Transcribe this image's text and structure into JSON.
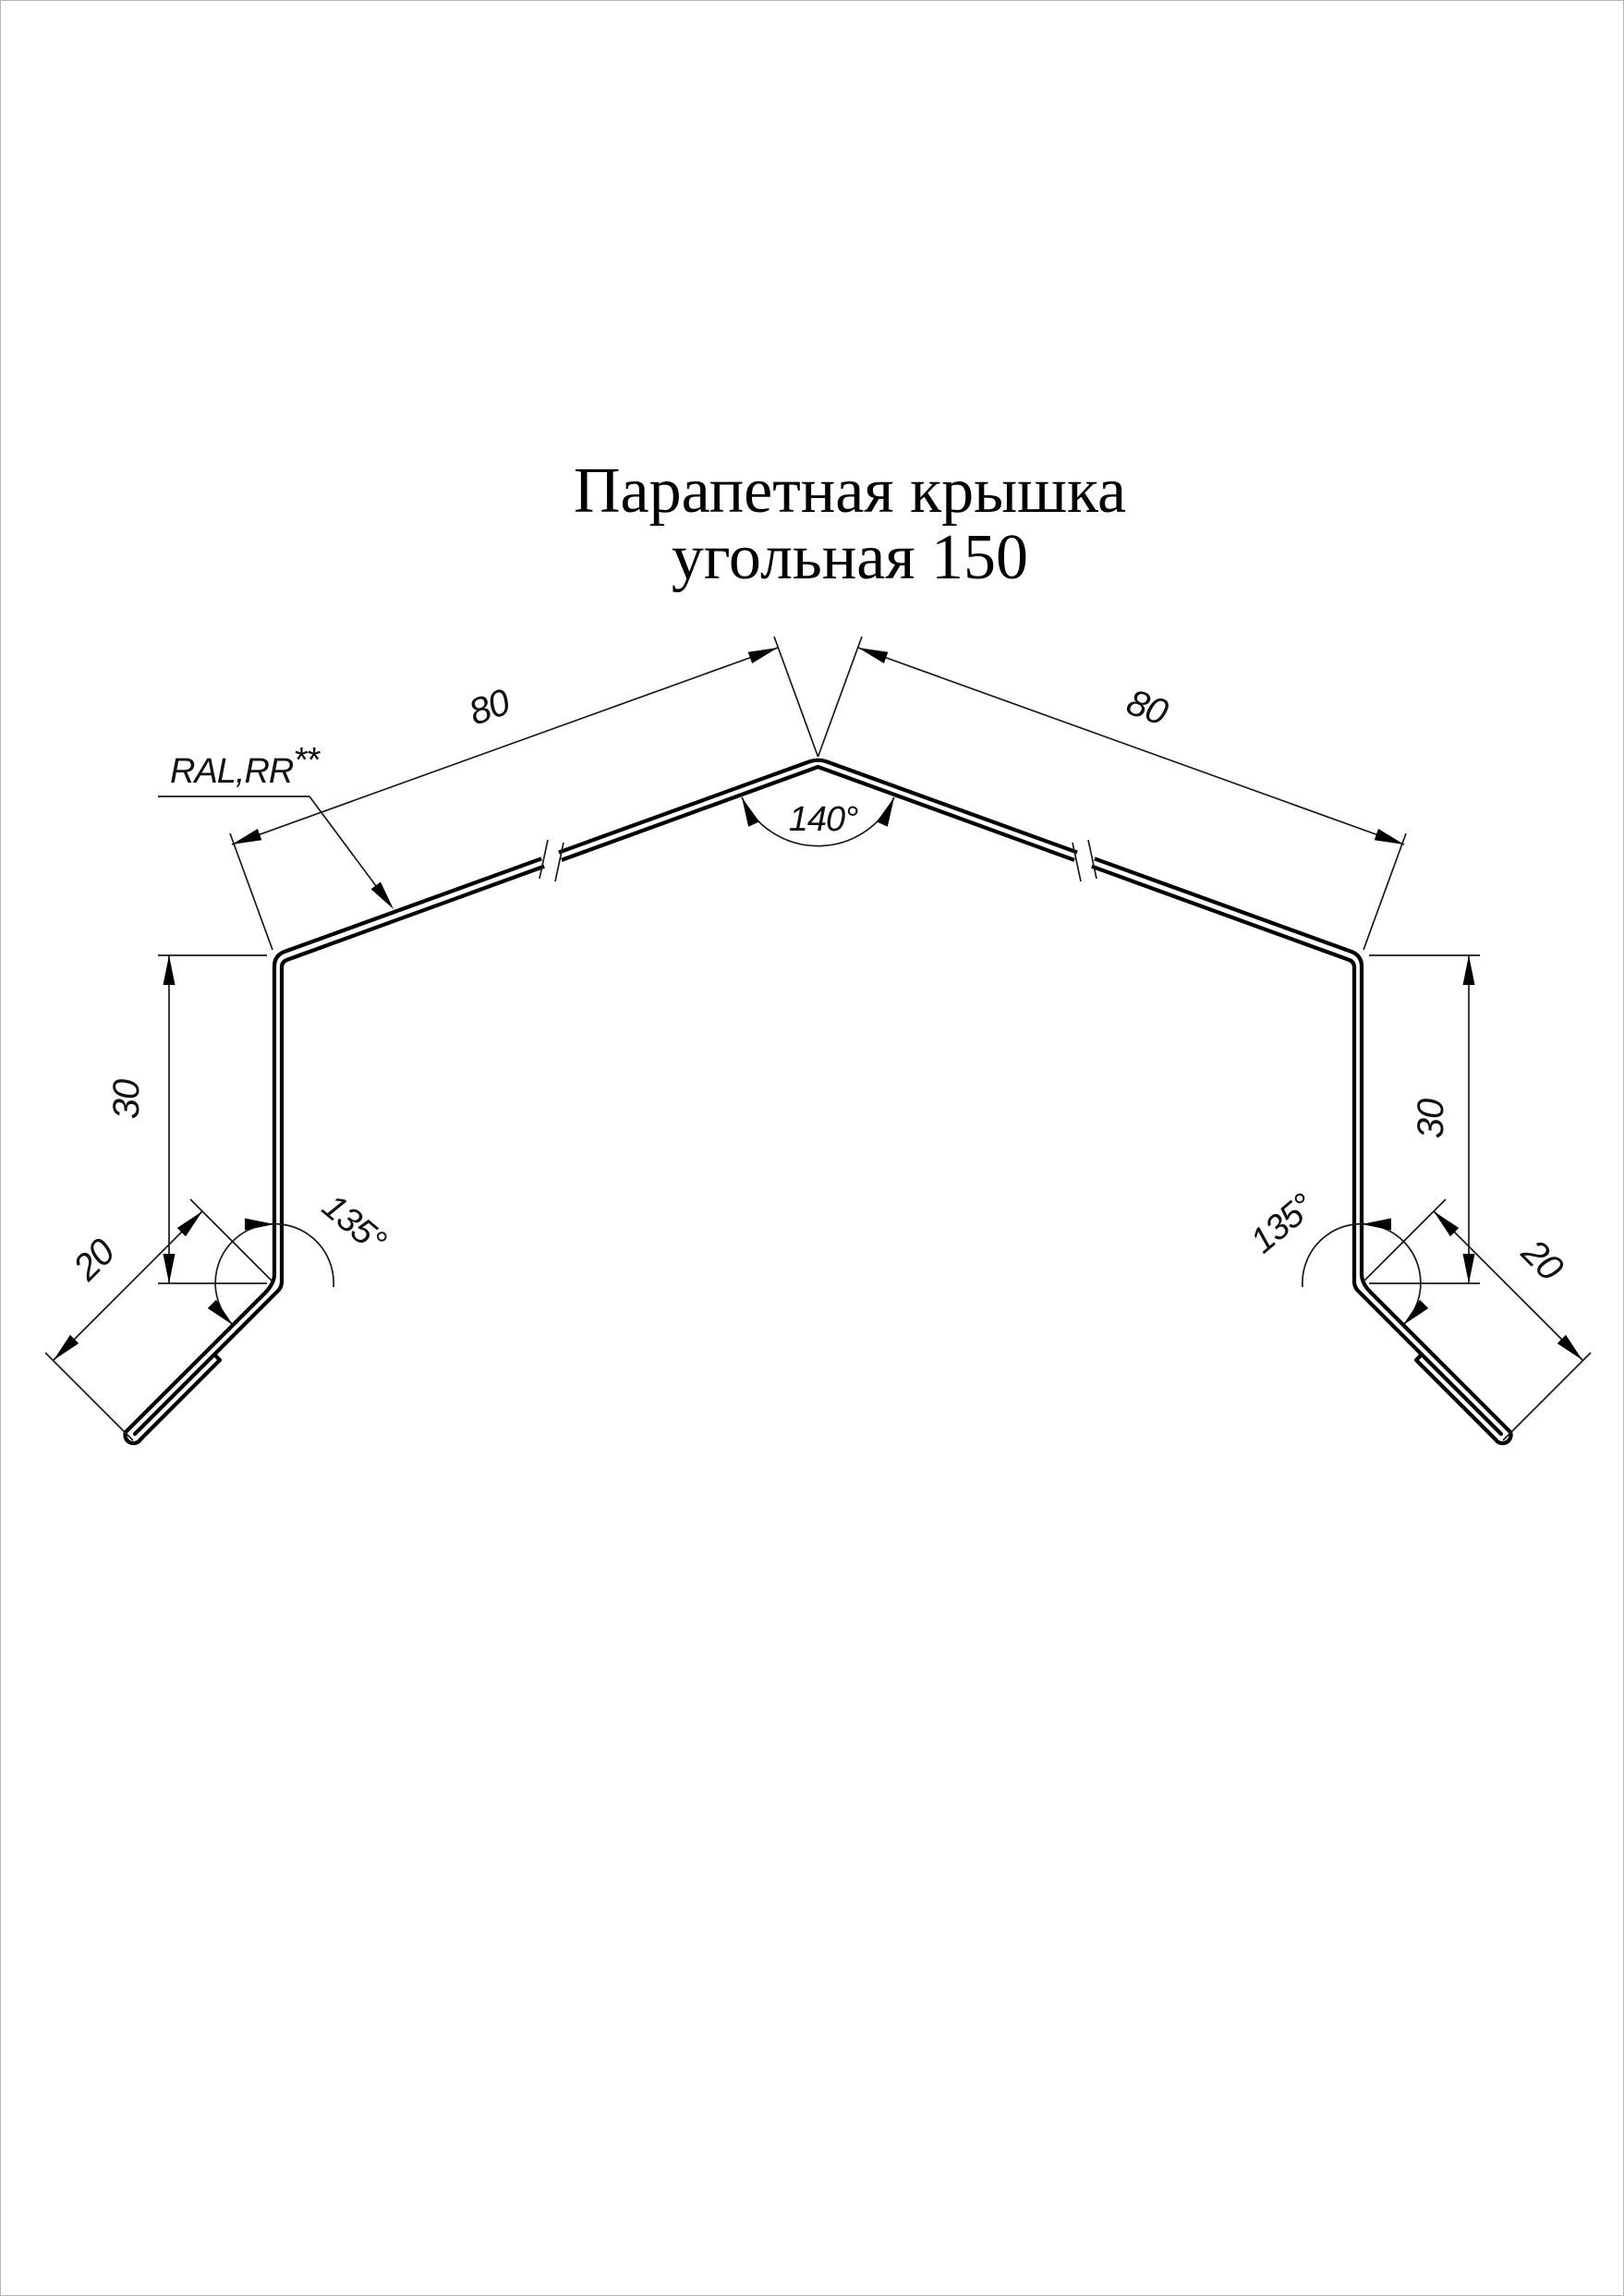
{
  "page": {
    "background": "#ffffff",
    "line_color": "#000000",
    "border_color": "#b5b5b5"
  },
  "title": {
    "line1": "Парапетная крышка",
    "line2": "угольная 150"
  },
  "dimensions": {
    "slope_left": "80",
    "slope_right": "80",
    "apex_angle": "140°",
    "upstand_left": "30",
    "upstand_right": "30",
    "kick_left": "20",
    "kick_right": "20",
    "kick_angle_left": "135°",
    "kick_angle_right": "135°"
  },
  "annotations": {
    "coating": "RAL,RR",
    "coating_marks": "**"
  }
}
